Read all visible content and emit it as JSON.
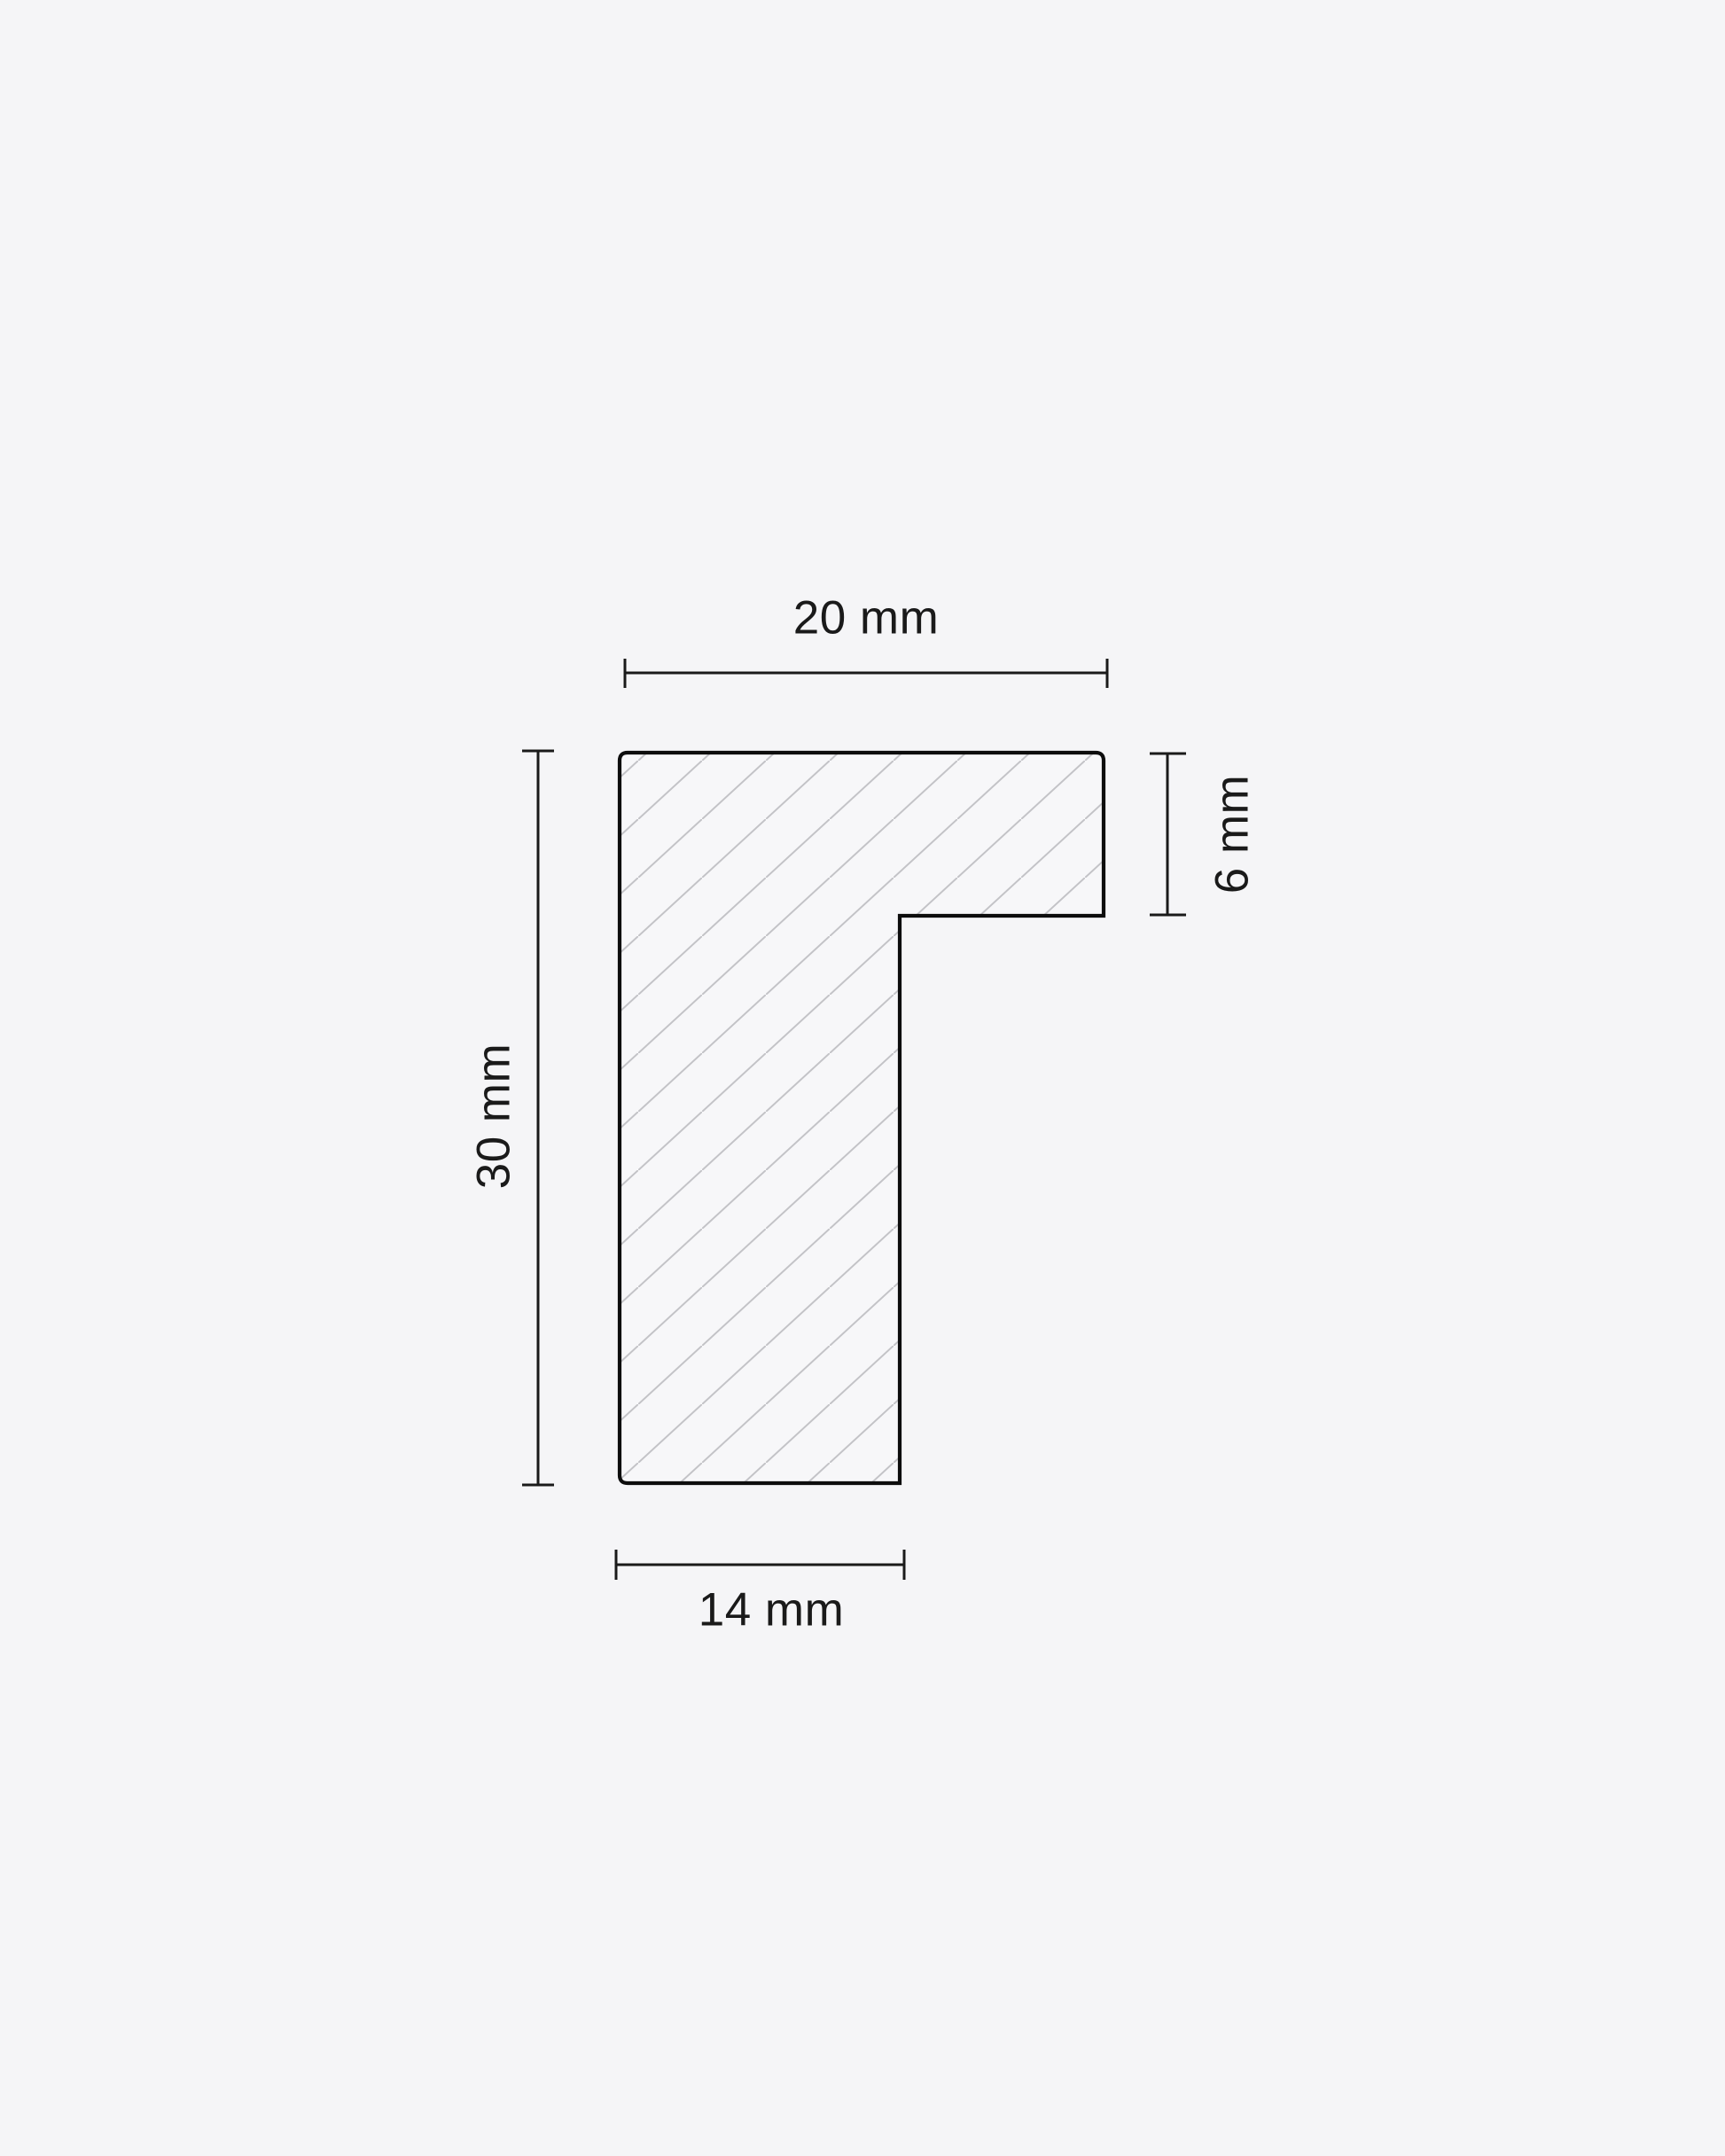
{
  "diagram": {
    "type": "technical-cross-section",
    "subject": "moulding-profile-with-hatching",
    "units": "mm",
    "dimensions": {
      "top": {
        "label": "20 mm",
        "value": 20
      },
      "left": {
        "label": "30 mm",
        "value": 30
      },
      "right": {
        "label": "6 mm",
        "value": 6
      },
      "bottom": {
        "label": "14 mm",
        "value": 14
      }
    },
    "colors": {
      "background": "#f5f5f7",
      "shape_fill": "#f7f7f9",
      "outline": "#0d0d0d",
      "hatch": "#c3c3c7",
      "dimension_lines": "#1a1a1a",
      "text": "#1a1a1a"
    }
  }
}
